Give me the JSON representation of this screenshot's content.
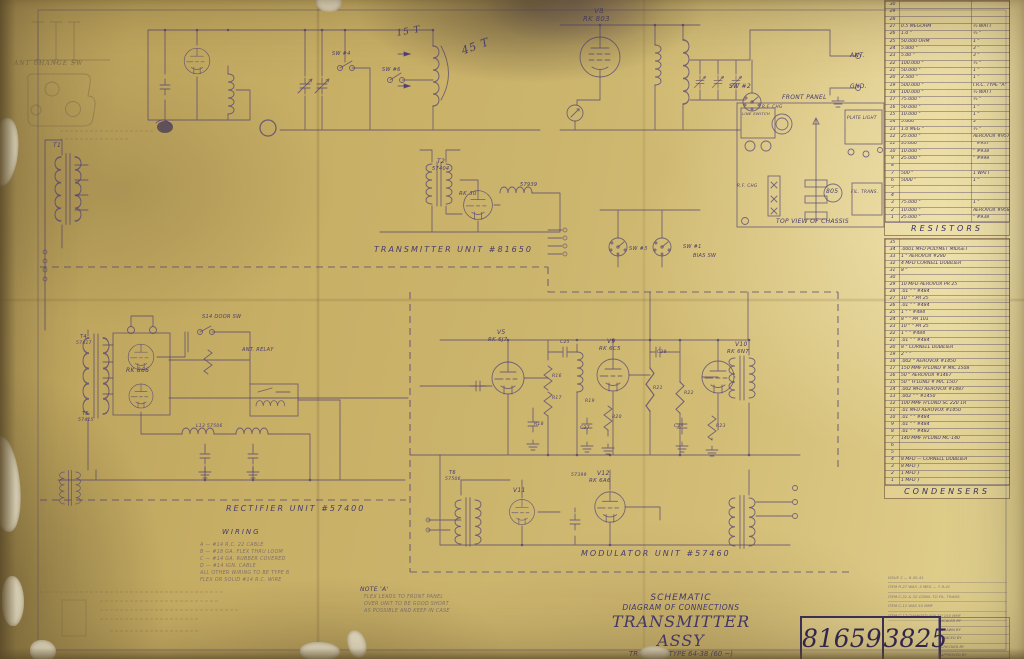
{
  "colors": {
    "paper": "#c8af66",
    "ink": "#4d3f75",
    "pencil": "#7a6a48"
  },
  "sheet_title": {
    "line1": "SCHEMATIC",
    "line2": "DIAGRAM OF CONNECTIONS",
    "line3": "TRANSMITTER ASSY",
    "line4": "TR 200 MS TYPE 64-38 (60 ~)"
  },
  "drawing_numbers": {
    "left": "81659",
    "right": "3825"
  },
  "resistor_table": {
    "title": "RESISTORS",
    "rows": [
      {
        "n": "30",
        "v": "",
        "w": ""
      },
      {
        "n": "29",
        "v": "",
        "w": ""
      },
      {
        "n": "28",
        "v": "",
        "w": ""
      },
      {
        "n": "27",
        "v": "0.5 MEGOHM",
        "w": "½ WATT"
      },
      {
        "n": "26",
        "v": "1.0  \"",
        "w": "½  \""
      },
      {
        "n": "25",
        "v": "50.000 OHM",
        "w": "1  \""
      },
      {
        "n": "24",
        "v": "5.000  \"",
        "w": "3  \""
      },
      {
        "n": "23",
        "v": "5.00  \"",
        "w": "3  \""
      },
      {
        "n": "22",
        "v": "100.000  \"",
        "w": "½  \""
      },
      {
        "n": "21",
        "v": "50.000  \"",
        "w": "1  \""
      },
      {
        "n": "20",
        "v": "2.500  \"",
        "w": "1  \""
      },
      {
        "n": "19",
        "v": "500.000  \"",
        "w": "I.R.C. TYPE \"A\""
      },
      {
        "n": "18",
        "v": "100.000  \"",
        "w": "½ WATT"
      },
      {
        "n": "17",
        "v": "75.000  \"",
        "w": "½  \""
      },
      {
        "n": "16",
        "v": "50.000  \"",
        "w": "1  \""
      },
      {
        "n": "15",
        "v": "10.000  \"",
        "w": "1  \""
      },
      {
        "n": "14",
        "v": "5.000  \"",
        "w": "3  \""
      },
      {
        "n": "13",
        "v": "1.0 MEG  \"",
        "w": "½  \""
      },
      {
        "n": "12",
        "v": "25.000  \"",
        "w": "AEROVOX #957"
      },
      {
        "n": "11",
        "v": "35.000  \"",
        "w": "\"  #937"
      },
      {
        "n": "10",
        "v": "10.000  \"",
        "w": "\"  #938"
      },
      {
        "n": "9",
        "v": "25.000  \"",
        "w": "\"  #998"
      },
      {
        "n": "8",
        "v": "",
        "w": ""
      },
      {
        "n": "7",
        "v": "500  \"",
        "w": "1 WATT"
      },
      {
        "n": "6",
        "v": "5000  \"",
        "w": "1  \""
      },
      {
        "n": "5",
        "v": "",
        "w": ""
      },
      {
        "n": "4",
        "v": "",
        "w": ""
      },
      {
        "n": "3",
        "v": "75.000  \"",
        "w": "1  \""
      },
      {
        "n": "2",
        "v": "10.000  \"",
        "w": "AEROVOX #958"
      },
      {
        "n": "1",
        "v": "25.000  \"",
        "w": "\"  #938"
      }
    ]
  },
  "condenser_table": {
    "title": "CONDENSERS",
    "rows": [
      {
        "n": "35",
        "v": ""
      },
      {
        "n": "34",
        "v": ".0001 MFD POLYMET MIDGET"
      },
      {
        "n": "33",
        "v": "1  \"  AEROVOX #280"
      },
      {
        "n": "32",
        "v": "4 MFD CORNELL DUBILIER"
      },
      {
        "n": "31",
        "v": "8  \""
      },
      {
        "n": "30",
        "v": ""
      },
      {
        "n": "29",
        "v": "10 MFD AEROVOX PR 25"
      },
      {
        "n": "28",
        "v": ".01  \"  \"  #484"
      },
      {
        "n": "27",
        "v": "10  \"  \"  PR 25"
      },
      {
        "n": "26",
        "v": ".01  \"  \"  #484"
      },
      {
        "n": "25",
        "v": "1  \"  \"  #484"
      },
      {
        "n": "24",
        "v": "8  \"  \"  PR 101"
      },
      {
        "n": "23",
        "v": "10  \"  \"  PR 25"
      },
      {
        "n": "22",
        "v": "1  \"  \"  #484"
      },
      {
        "n": "21",
        "v": ".01  \"  \"  #484"
      },
      {
        "n": "20",
        "v": "8  \"  CORNELL DUBILIER"
      },
      {
        "n": "19",
        "v": "2  \"  \""
      },
      {
        "n": "18",
        "v": ".002  \"  AEROVOX #1450"
      },
      {
        "n": "17",
        "v": "150 MMF H'LUND # MIC 1508"
      },
      {
        "n": "16",
        "v": "50  \"  AEROVOX #1467"
      },
      {
        "n": "15",
        "v": "50  \"  H'LUND # MIC 1507"
      },
      {
        "n": "14",
        "v": ".002 MFD AEROVOX #1487"
      },
      {
        "n": "13",
        "v": ".002  \"  \"  #1450"
      },
      {
        "n": "12",
        "v": "100 MMF H'LUND SC 220 1R"
      },
      {
        "n": "11",
        "v": ".01 MFD AEROVOX #1450"
      },
      {
        "n": "10",
        "v": ".01  \"  \"  #484"
      },
      {
        "n": "9",
        "v": ".01  \"  \"  #484"
      },
      {
        "n": "8",
        "v": ".01  \"  \"  #482"
      },
      {
        "n": "7",
        "v": "140 MMF H'LUND MC-140"
      },
      {
        "n": "6",
        "v": ""
      },
      {
        "n": "5",
        "v": ""
      },
      {
        "n": "4",
        "v": "8 MFD — CORNELL DUBILIER"
      },
      {
        "n": "3",
        "v": "8 MFD }"
      },
      {
        "n": "2",
        "v": "1 MFD }"
      },
      {
        "n": "1",
        "v": "1 MFD }"
      }
    ]
  },
  "rev_lines": [
    {
      "text": "ISSUE 2 — 6-30-41"
    },
    {
      "text": "ITEM R-27 WAS .5 MEG — 7-9-41"
    },
    {
      "text": "ITEM C-31 & 32 CONN. TO FIL. TRANS."
    },
    {
      "text": "ITEM C-12 WAS 50 MMF"
    },
    {
      "text": "ITEM C-17 CHANGED 500 TO 150 MMF"
    }
  ],
  "sign_rows": [
    {
      "label": "SCALED BY"
    },
    {
      "label": "DRAWN BY"
    },
    {
      "label": "TRACED BY"
    },
    {
      "label": "CHECKED BY"
    },
    {
      "label": "APPROVED BY"
    }
  ],
  "annotations": [
    {
      "text": "V8",
      "x": 594,
      "y": 8,
      "fs": 7,
      "cls": "ink"
    },
    {
      "text": "RK 803",
      "x": 583,
      "y": 16,
      "fs": 7,
      "cls": "ink"
    },
    {
      "text": "15 T",
      "x": 396,
      "y": 30,
      "fs": 9,
      "cls": "hand",
      "rot": -10
    },
    {
      "text": "45 T",
      "x": 460,
      "y": 46,
      "fs": 11,
      "cls": "hand",
      "rot": -20
    },
    {
      "text": "SW #4",
      "x": 332,
      "y": 52,
      "fs": 5,
      "cls": "ink"
    },
    {
      "text": "SW #6",
      "x": 382,
      "y": 68,
      "fs": 5,
      "cls": "ink"
    },
    {
      "text": "ANT.",
      "x": 850,
      "y": 53,
      "fs": 6,
      "cls": "ink"
    },
    {
      "text": "GND.",
      "x": 850,
      "y": 84,
      "fs": 6,
      "cls": "ink"
    },
    {
      "text": "SW #2",
      "x": 729,
      "y": 84,
      "fs": 6,
      "cls": "ink"
    },
    {
      "text": "T2",
      "x": 437,
      "y": 159,
      "fs": 6,
      "cls": "ink"
    },
    {
      "text": "57404",
      "x": 432,
      "y": 167,
      "fs": 5,
      "cls": "ink"
    },
    {
      "text": "RK 30",
      "x": 459,
      "y": 192,
      "fs": 5.5,
      "cls": "ink"
    },
    {
      "text": "57939",
      "x": 520,
      "y": 183,
      "fs": 5,
      "cls": "ink"
    },
    {
      "text": "SW #3",
      "x": 629,
      "y": 247,
      "fs": 5,
      "cls": "ink"
    },
    {
      "text": "SW #1",
      "x": 683,
      "y": 245,
      "fs": 5,
      "cls": "ink"
    },
    {
      "text": "BIAS SW",
      "x": 693,
      "y": 254,
      "fs": 5,
      "cls": "ink"
    },
    {
      "text": "T1",
      "x": 53,
      "y": 143,
      "fs": 6,
      "cls": "ink"
    },
    {
      "text": "TRANSMITTER UNIT #81650",
      "x": 374,
      "y": 246,
      "fs": 8,
      "cls": "sp"
    },
    {
      "text": "FRONT PANEL",
      "x": 782,
      "y": 95,
      "fs": 6,
      "cls": "ink"
    },
    {
      "text": "LINE SWITCH",
      "x": 742,
      "y": 112,
      "fs": 3.8,
      "cls": "ink"
    },
    {
      "text": "R.F. CHG",
      "x": 762,
      "y": 105,
      "fs": 4.2,
      "cls": "ink"
    },
    {
      "text": "PLATE LIGHT",
      "x": 847,
      "y": 116,
      "fs": 4.2,
      "cls": "ink"
    },
    {
      "text": "805",
      "x": 826,
      "y": 189,
      "fs": 6,
      "cls": "ink"
    },
    {
      "text": "FIL. TRANS.",
      "x": 851,
      "y": 190,
      "fs": 4.2,
      "cls": "ink"
    },
    {
      "text": "R.F. CHG",
      "x": 737,
      "y": 184,
      "fs": 4.2,
      "cls": "ink"
    },
    {
      "text": "TOP VIEW OF CHASSIS",
      "x": 776,
      "y": 219,
      "fs": 6,
      "cls": "ink"
    },
    {
      "text": "S14 DOOR SW",
      "x": 202,
      "y": 315,
      "fs": 5,
      "cls": "ink"
    },
    {
      "text": "T4",
      "x": 80,
      "y": 335,
      "fs": 5,
      "cls": "ink"
    },
    {
      "text": "57417",
      "x": 76,
      "y": 342,
      "fs": 4.5,
      "cls": "ink"
    },
    {
      "text": "RK 866",
      "x": 126,
      "y": 368,
      "fs": 6,
      "cls": "ink"
    },
    {
      "text": "T5",
      "x": 82,
      "y": 412,
      "fs": 5,
      "cls": "ink"
    },
    {
      "text": "57415",
      "x": 78,
      "y": 419,
      "fs": 4.5,
      "cls": "ink"
    },
    {
      "text": "ANT. RELAY",
      "x": 242,
      "y": 348,
      "fs": 5,
      "cls": "ink"
    },
    {
      "text": "L13 57506",
      "x": 196,
      "y": 425,
      "fs": 4.5,
      "cls": "ink"
    },
    {
      "text": "RECTIFIER UNIT #57400",
      "x": 226,
      "y": 505,
      "fs": 8,
      "cls": "sp"
    },
    {
      "text": "V5",
      "x": 497,
      "y": 330,
      "fs": 6,
      "cls": "ink"
    },
    {
      "text": "RK 6J7",
      "x": 488,
      "y": 338,
      "fs": 5.5,
      "cls": "ink"
    },
    {
      "text": "V9",
      "x": 607,
      "y": 339,
      "fs": 6,
      "cls": "ink"
    },
    {
      "text": "RK 6C5",
      "x": 599,
      "y": 347,
      "fs": 5.5,
      "cls": "ink"
    },
    {
      "text": "V10",
      "x": 735,
      "y": 342,
      "fs": 6,
      "cls": "ink"
    },
    {
      "text": "RK 6N7",
      "x": 727,
      "y": 350,
      "fs": 5.5,
      "cls": "ink"
    },
    {
      "text": "V11",
      "x": 513,
      "y": 488,
      "fs": 6,
      "cls": "ink"
    },
    {
      "text": "V12",
      "x": 597,
      "y": 471,
      "fs": 6,
      "cls": "ink"
    },
    {
      "text": "RK 6A6",
      "x": 589,
      "y": 479,
      "fs": 5.5,
      "cls": "ink"
    },
    {
      "text": "T6",
      "x": 449,
      "y": 471,
      "fs": 5,
      "cls": "ink"
    },
    {
      "text": "57506",
      "x": 445,
      "y": 478,
      "fs": 4.5,
      "cls": "ink"
    },
    {
      "text": "57399",
      "x": 571,
      "y": 474,
      "fs": 4.5,
      "cls": "ink"
    },
    {
      "text": "R16",
      "x": 552,
      "y": 375,
      "fs": 4.5,
      "cls": "ink"
    },
    {
      "text": "R17",
      "x": 552,
      "y": 397,
      "fs": 4.5,
      "cls": "ink"
    },
    {
      "text": "R18",
      "x": 534,
      "y": 423,
      "fs": 4.5,
      "cls": "ink"
    },
    {
      "text": "R19",
      "x": 585,
      "y": 400,
      "fs": 4.5,
      "cls": "ink"
    },
    {
      "text": "R20",
      "x": 612,
      "y": 416,
      "fs": 4.5,
      "cls": "ink"
    },
    {
      "text": "R21",
      "x": 653,
      "y": 387,
      "fs": 4.5,
      "cls": "ink"
    },
    {
      "text": "R22",
      "x": 684,
      "y": 392,
      "fs": 4.5,
      "cls": "ink"
    },
    {
      "text": "R23",
      "x": 716,
      "y": 425,
      "fs": 4.5,
      "cls": "ink"
    },
    {
      "text": "C25",
      "x": 560,
      "y": 341,
      "fs": 4.5,
      "cls": "ink"
    },
    {
      "text": "C27",
      "x": 580,
      "y": 427,
      "fs": 4.5,
      "cls": "ink"
    },
    {
      "text": "C28",
      "x": 657,
      "y": 351,
      "fs": 4.5,
      "cls": "ink"
    },
    {
      "text": "C29",
      "x": 674,
      "y": 425,
      "fs": 4.5,
      "cls": "ink"
    },
    {
      "text": "MODULATOR UNIT #57460",
      "x": 581,
      "y": 550,
      "fs": 8,
      "cls": "sp"
    },
    {
      "text": "ANT CHANGE SW",
      "x": 14,
      "y": 61,
      "fs": 6,
      "cls": "pencil hand"
    },
    {
      "text": "WIRING",
      "x": 222,
      "y": 529,
      "fs": 7,
      "cls": "sp"
    },
    {
      "text": "A — #14 R.C. 22 CABLE",
      "x": 200,
      "y": 543,
      "fs": 4.8,
      "cls": "faint"
    },
    {
      "text": "B — #18 GA. FLEX THRU LOOM",
      "x": 200,
      "y": 550,
      "fs": 4.8,
      "cls": "faint"
    },
    {
      "text": "C — #14 GA. RUBBER COVERED",
      "x": 200,
      "y": 557,
      "fs": 4.8,
      "cls": "faint"
    },
    {
      "text": "D — #14 IGN. CABLE",
      "x": 200,
      "y": 564,
      "fs": 4.8,
      "cls": "faint"
    },
    {
      "text": "ALL OTHER WIRING TO BE TYPE B",
      "x": 200,
      "y": 571,
      "fs": 4.8,
      "cls": "faint"
    },
    {
      "text": "FLEX OR SOLID #14 R.C. WIRE",
      "x": 200,
      "y": 578,
      "fs": 4.8,
      "cls": "faint"
    },
    {
      "text": "NOTE 'A'",
      "x": 360,
      "y": 587,
      "fs": 6,
      "cls": "ink"
    },
    {
      "text": "FLEX LEADS TO FRONT PANEL",
      "x": 364,
      "y": 595,
      "fs": 4.8,
      "cls": "faint"
    },
    {
      "text": "OVER UNIT TO BE GOOD SHORT",
      "x": 364,
      "y": 602,
      "fs": 4.8,
      "cls": "faint"
    },
    {
      "text": "AS POSSIBLE AND KEEP IN CASE",
      "x": 364,
      "y": 609,
      "fs": 4.8,
      "cls": "faint"
    }
  ]
}
